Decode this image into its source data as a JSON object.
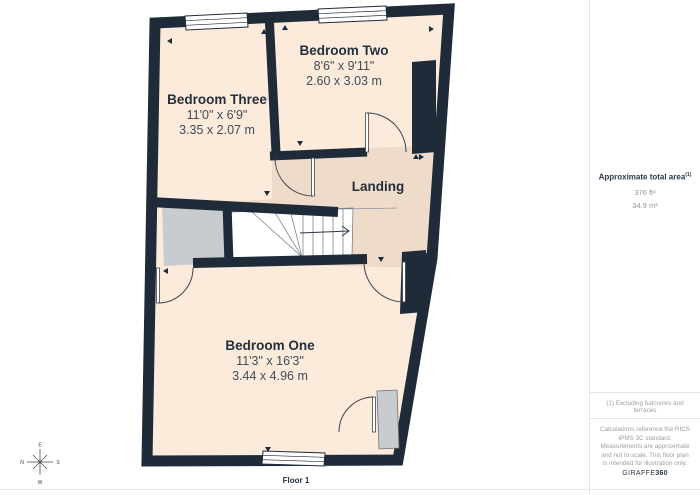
{
  "floorplan": {
    "floor_label": "Floor 1",
    "rooms": {
      "bedroom_three": {
        "name": "Bedroom Three",
        "imperial": "11'0\" x 6'9\"",
        "metric": "3.35 x 2.07 m"
      },
      "bedroom_two": {
        "name": "Bedroom Two",
        "imperial": "8'6\" x 9'11\"",
        "metric": "2.60 x 3.03 m"
      },
      "landing": {
        "name": "Landing"
      },
      "bedroom_one": {
        "name": "Bedroom One",
        "imperial": "11'3\" x 16'3\"",
        "metric": "3.44 x 4.96 m"
      }
    },
    "colors": {
      "wall": "#1f2b39",
      "room_fill": "#fcebdb",
      "landing_fill": "#efdbca",
      "void_gray": "#c9cccf",
      "stairs_white": "#ffffff"
    }
  },
  "compass": {
    "north": "N",
    "east": "E",
    "south": "S",
    "west": "W"
  },
  "sidebar": {
    "total_area_label": "Approximate total area",
    "total_area_superscript": "(1)",
    "area_sqft": "376 ft²",
    "area_sqm": "34.9 m²",
    "footnote": "(1) Excluding balconies and terraces",
    "disclaimer": "Calculations reference the RICS IPMS 3C standard. Measurements are approximate and not to scale. This floor plan is intended for illustration only.",
    "brand_name": "GIRAFFE",
    "brand_suffix": "360"
  }
}
